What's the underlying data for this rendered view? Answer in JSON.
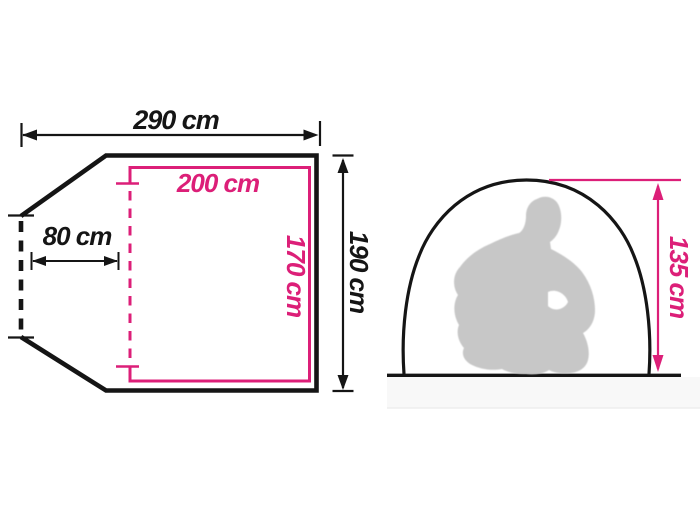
{
  "diagram": {
    "type": "tent-dimensions-diagram",
    "unit": "cm",
    "labels": {
      "total_width": "290 cm",
      "vestibule_depth": "80 cm",
      "inner_width": "200 cm",
      "inner_depth": "170 cm",
      "total_depth": "190 cm",
      "peak_height": "135 cm"
    },
    "dimensions_cm": {
      "total_width": 290,
      "vestibule_depth": 80,
      "inner_width": 200,
      "inner_depth": 170,
      "total_depth": 190,
      "peak_height": 135
    },
    "figures": {
      "person_silhouette": "crouching-adult-silhouette",
      "left_view": "floor-plan-top-view",
      "right_view": "tent-side-view"
    },
    "colors": {
      "outline_black": "#151515",
      "accent_pink": "#dc1f78",
      "silhouette_gray": "#c7c7c7",
      "ground_shadow": "#f8f8f8",
      "background": "#ffffff"
    }
  }
}
